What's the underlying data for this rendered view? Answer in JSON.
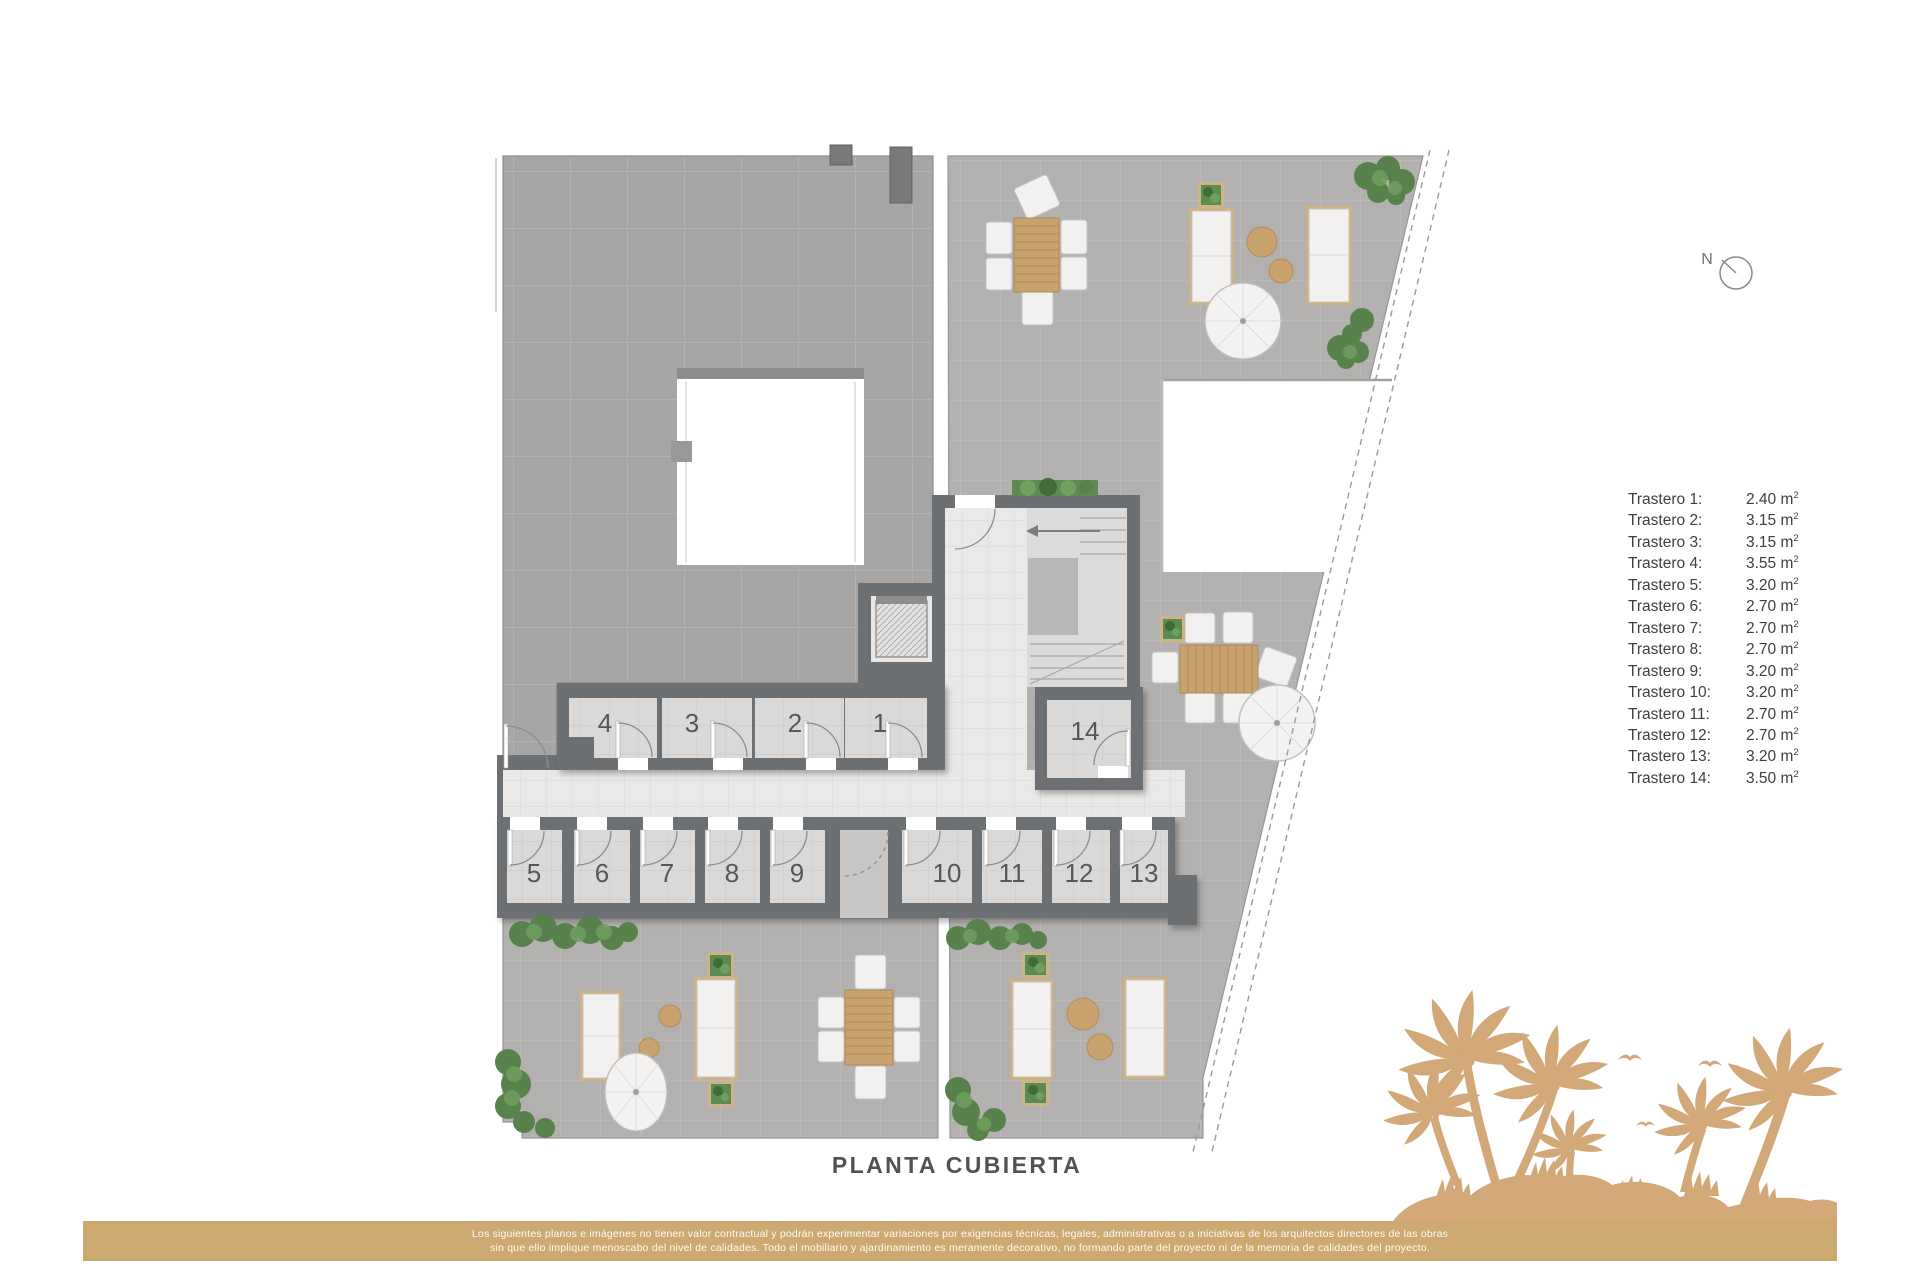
{
  "title": {
    "text": "PLANTA CUBIERTA"
  },
  "compass": {
    "label": "N"
  },
  "legend": {
    "unit": "m",
    "unit_exponent": "2",
    "items": [
      {
        "label": "Trastero 1:",
        "value": "2.40"
      },
      {
        "label": "Trastero 2:",
        "value": "3.15"
      },
      {
        "label": "Trastero 3:",
        "value": "3.15"
      },
      {
        "label": "Trastero 4:",
        "value": "3.55"
      },
      {
        "label": "Trastero 5:",
        "value": "3.20"
      },
      {
        "label": "Trastero 6:",
        "value": "2.70"
      },
      {
        "label": "Trastero 7:",
        "value": "2.70"
      },
      {
        "label": "Trastero 8:",
        "value": "2.70"
      },
      {
        "label": "Trastero 9:",
        "value": "3.20"
      },
      {
        "label": "Trastero 10:",
        "value": "3.20"
      },
      {
        "label": "Trastero 11:",
        "value": "2.70"
      },
      {
        "label": "Trastero 12:",
        "value": "2.70"
      },
      {
        "label": "Trastero 13:",
        "value": "3.20"
      },
      {
        "label": "Trastero 14:",
        "value": "3.50"
      }
    ]
  },
  "plan": {
    "room_labels": [
      "1",
      "2",
      "3",
      "4",
      "5",
      "6",
      "7",
      "8",
      "9",
      "10",
      "11",
      "12",
      "13",
      "14"
    ]
  },
  "footer": {
    "line1": "Los siguientes planos e imágenes no tienen valor contractual y podrán experimentar variaciones por exigencias técnicas, legales, administrativas o a iniciativas de los arquitectos directores de las obras",
    "line2": "sin que ello implique menoscabo del nivel de calidades. Todo el mobiliario y ajardinamiento es meramente decorativo, no formando parte del proyecto ni de la memoria de calidades del proyecto."
  },
  "colors": {
    "footer_bar": "#cda972",
    "palm": "#d2a878",
    "wall": "#6d7072",
    "roof": "#a8a6a4",
    "terrace": "#b3b1af",
    "corridor": "#eae9e7",
    "wood": "#c9a26d",
    "plant": "#4f7d45"
  }
}
